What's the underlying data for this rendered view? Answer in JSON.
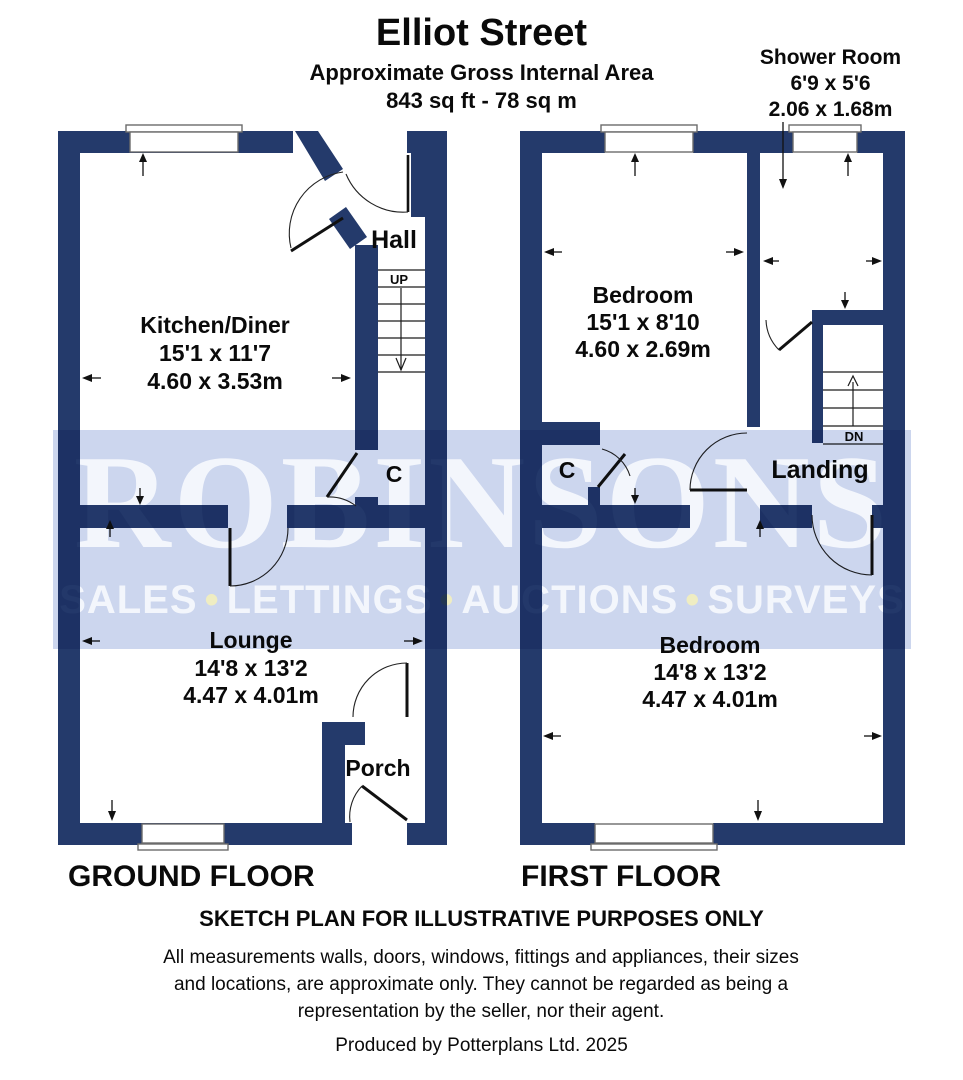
{
  "header": {
    "title": "Elliot Street",
    "subtitle": "Approximate Gross Internal Area",
    "area": "843 sq ft - 78 sq m"
  },
  "shower_label": {
    "name": "Shower Room",
    "imperial": "6'9 x 5'6",
    "metric": "2.06 x 1.68m"
  },
  "watermark": {
    "name": "ROBINSONS",
    "words": [
      "SALES",
      "LETTINGS",
      "AUCTIONS",
      "SURVEYS"
    ],
    "bullet": "•"
  },
  "ground_floor": {
    "label": "GROUND FLOOR",
    "rooms": {
      "kitchen": {
        "name": "Kitchen/Diner",
        "imperial": "15'1 x 11'7",
        "metric": "4.60 x 3.53m"
      },
      "hall": {
        "name": "Hall"
      },
      "stairs": {
        "direction": "UP"
      },
      "cupboard": {
        "name": "C"
      },
      "lounge": {
        "name": "Lounge",
        "imperial": "14'8 x 13'2",
        "metric": "4.47 x 4.01m"
      },
      "porch": {
        "name": "Porch"
      }
    }
  },
  "first_floor": {
    "label": "FIRST FLOOR",
    "rooms": {
      "bedroom_front": {
        "name": "Bedroom",
        "imperial": "15'1 x 8'10",
        "metric": "4.60 x 2.69m"
      },
      "landing": {
        "name": "Landing"
      },
      "stairs": {
        "direction": "DN"
      },
      "cupboard": {
        "name": "C"
      },
      "bedroom_rear": {
        "name": "Bedroom",
        "imperial": "14'8 x 13'2",
        "metric": "4.47 x 4.01m"
      }
    }
  },
  "footer": {
    "disclaimer_title": "SKETCH PLAN FOR ILLUSTRATIVE PURPOSES ONLY",
    "disclaimer_body": "All measurements walls, doors, windows, fittings and appliances, their sizes and locations, are approximate only. They cannot be regarded as being a representation by the seller, nor their agent.",
    "credit": "Produced by Potterplans Ltd. 2025"
  },
  "colors": {
    "wall": "#243a6b",
    "band": "#ccd6ee",
    "wmtext": "#f3f6fc"
  }
}
